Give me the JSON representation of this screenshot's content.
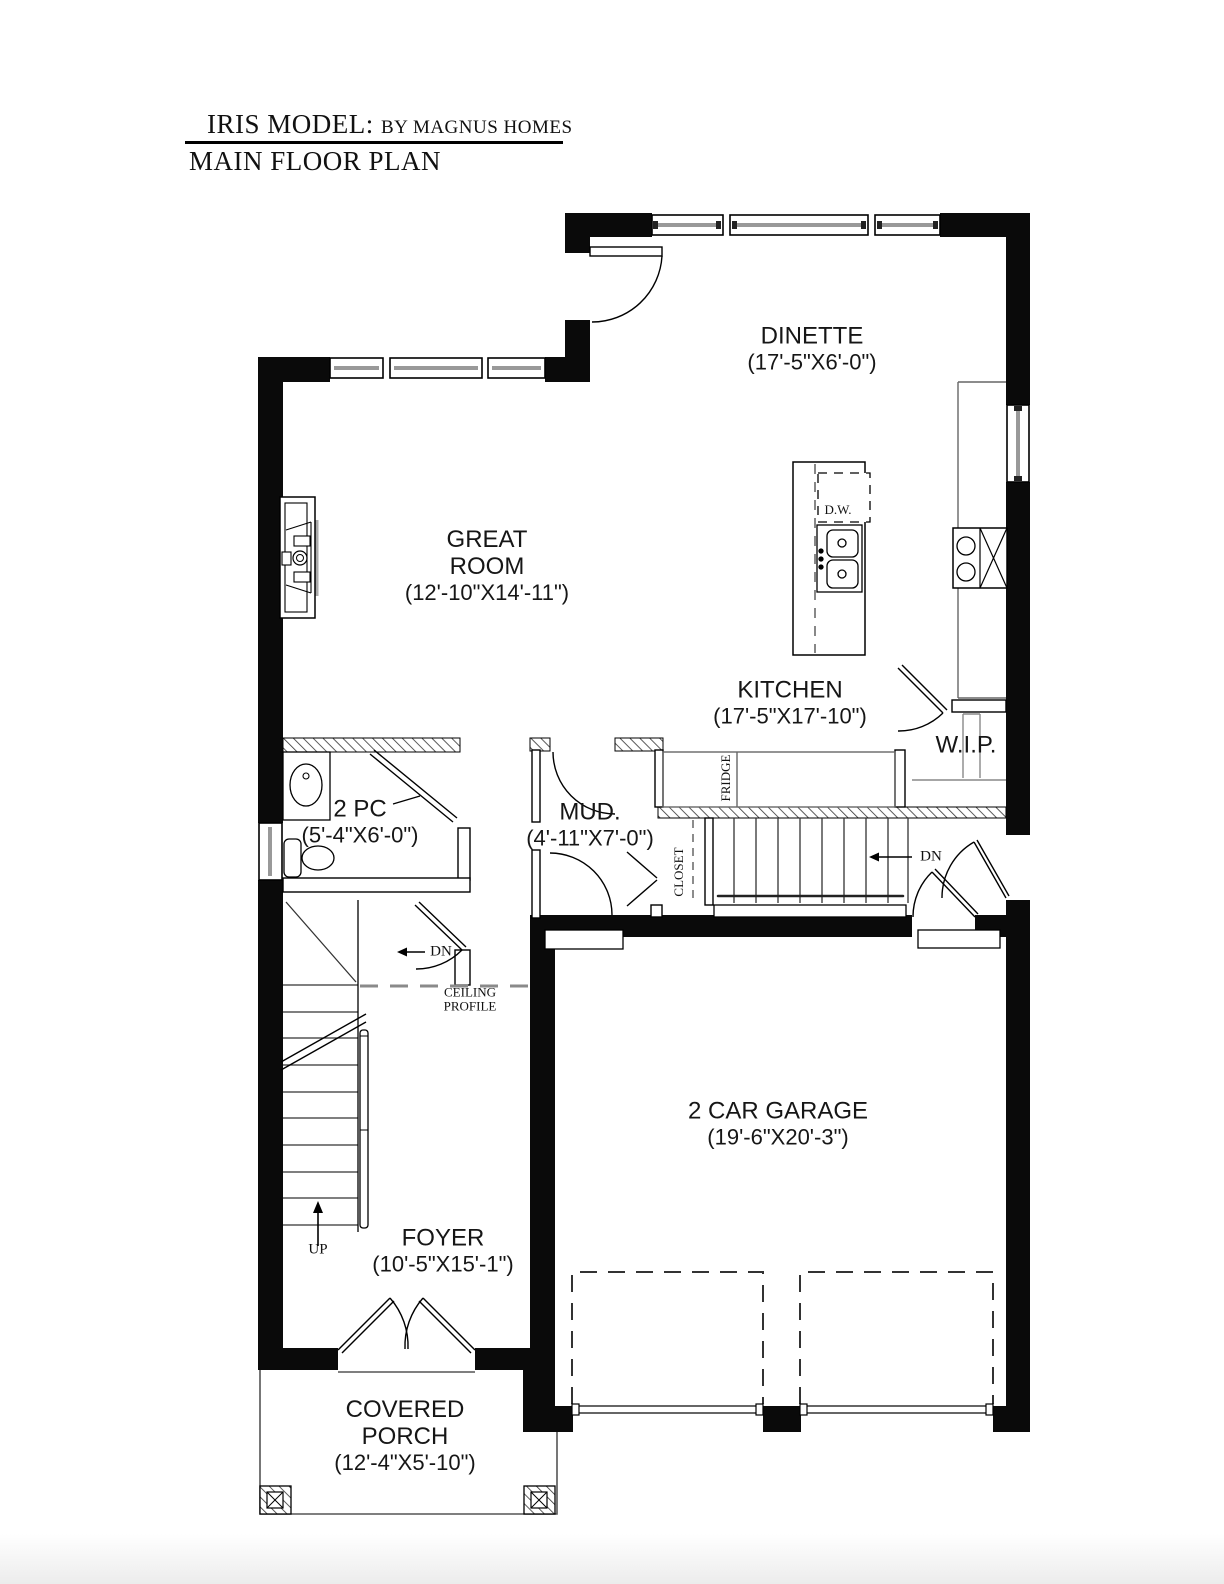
{
  "header": {
    "model": "IRIS MODEL:",
    "builder": "BY MAGNUS HOMES",
    "plan": "MAIN FLOOR PLAN"
  },
  "rooms": {
    "dinette": {
      "name": "DINETTE",
      "dims": "(17'-5\"X6'-0\")"
    },
    "great_room": {
      "name": "GREAT ROOM",
      "dims": "(12'-10\"X14'-11\")"
    },
    "kitchen": {
      "name": "KITCHEN",
      "dims": "(17'-5\"X17'-10\")"
    },
    "pantry": {
      "name": "W.I.P."
    },
    "powder": {
      "name": "2 PC",
      "dims": "(5'-4\"X6'-0\")"
    },
    "mud": {
      "name": "MUD.",
      "dims": "(4'-11\"X7'-0\")"
    },
    "garage": {
      "name": "2 CAR GARAGE",
      "dims": "(19'-6\"X20'-3\")"
    },
    "foyer": {
      "name": "FOYER",
      "dims": "(10'-5\"X15'-1\")"
    },
    "porch": {
      "name": "COVERED PORCH",
      "dims": "(12'-4\"X5'-10\")"
    }
  },
  "annotations": {
    "dishwasher": "D.W.",
    "fridge": "FRIDGE",
    "closet": "CLOSET",
    "dn_hall": "DN",
    "dn_stairs": "DN",
    "up": "UP",
    "ceiling_profile": "CEILING PROFILE"
  },
  "colors": {
    "wall": "#0a0a0a",
    "line": "#161616",
    "counter_gray": "#666666",
    "dash_gray": "#8a8a8a"
  }
}
